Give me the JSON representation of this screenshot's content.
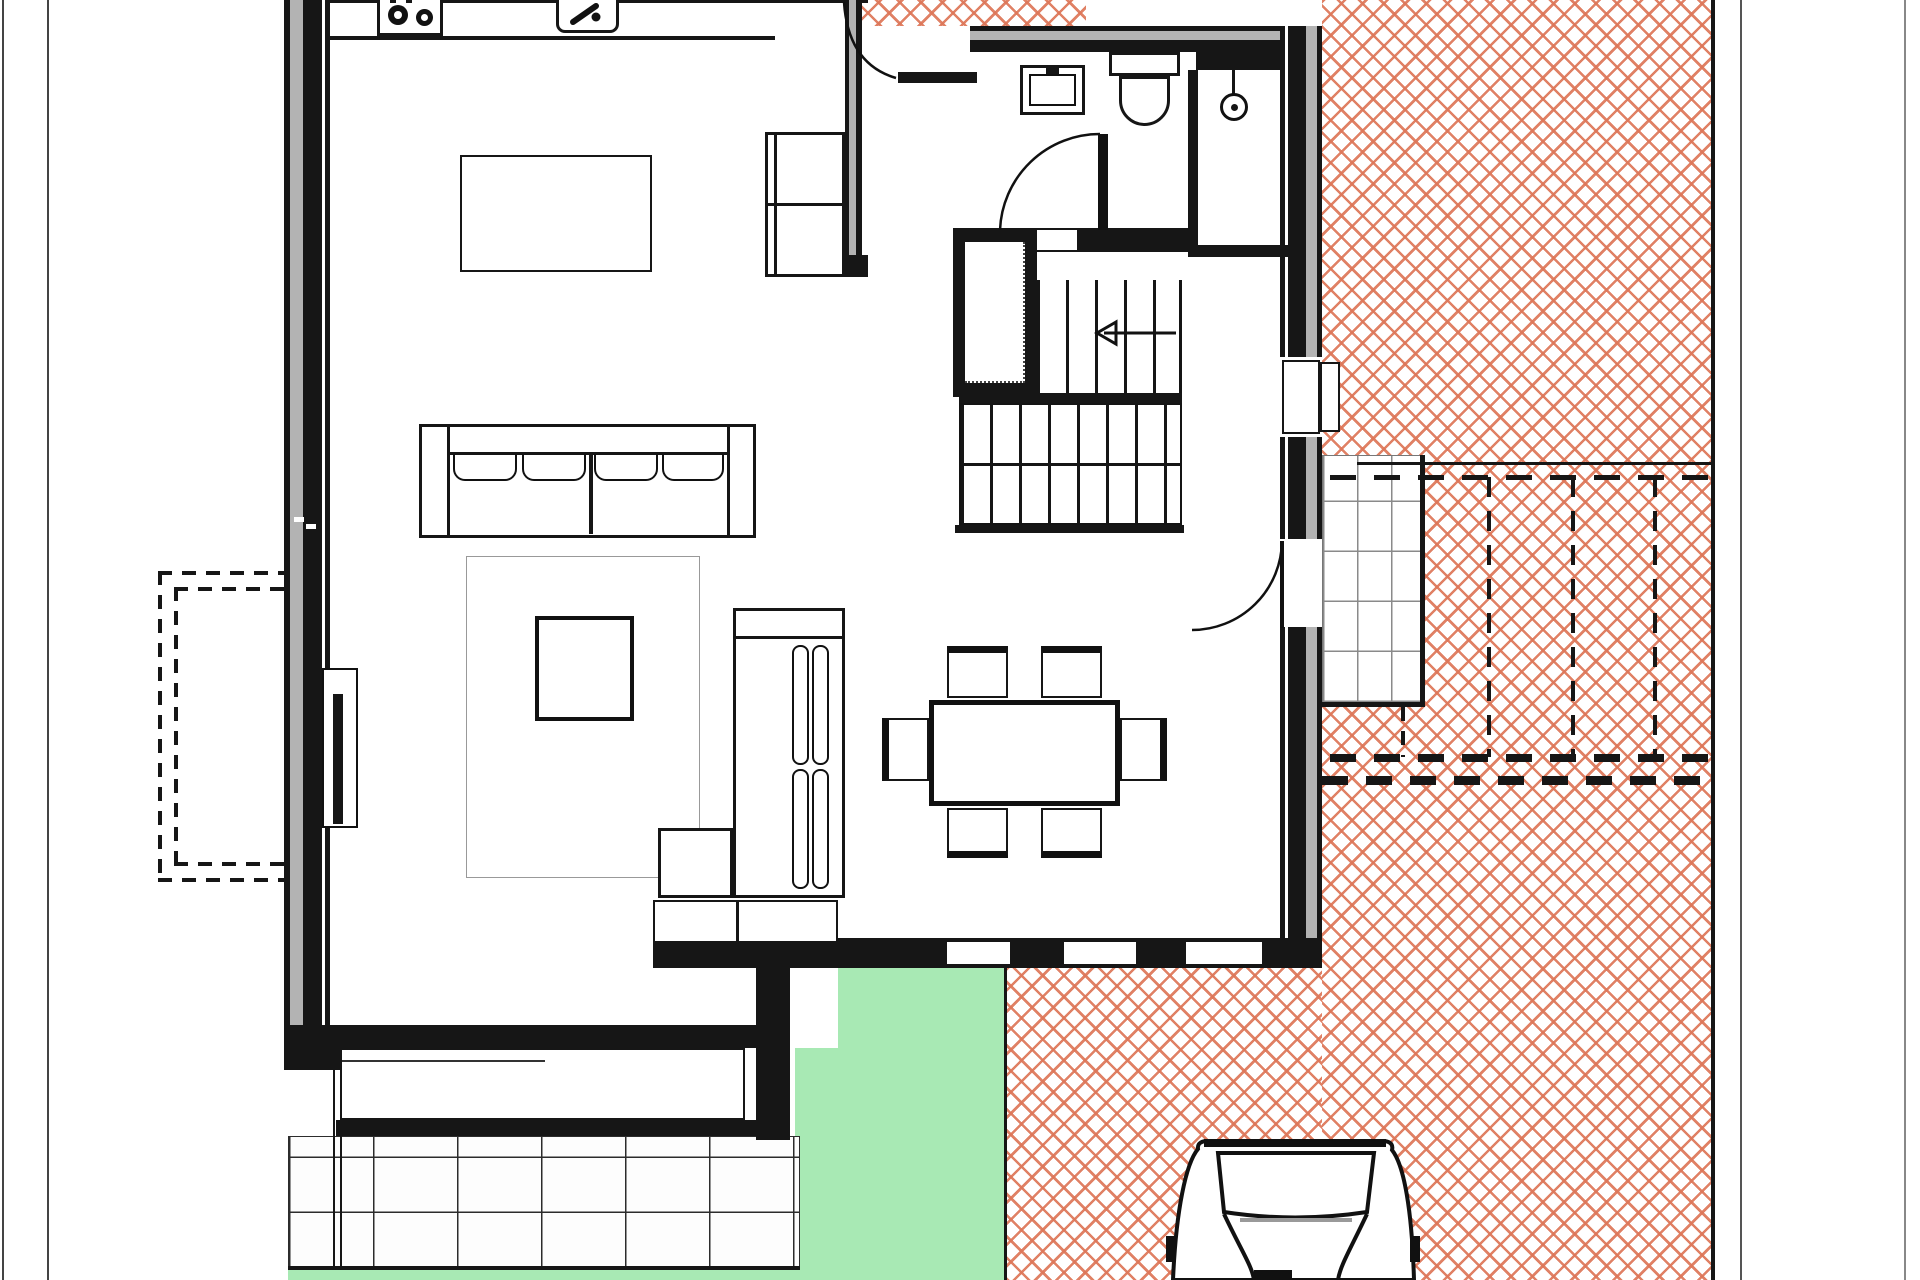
{
  "document": {
    "type": "architectural-floor-plan",
    "view": "top-down ground floor plan, partially cropped at top and bottom",
    "visible_text": []
  },
  "colors": {
    "background": "#ffffff",
    "ink": "#161616",
    "wall_core": "#b3b3b3",
    "paving_brick": "rgba(221,118,88,0.92)",
    "lawn_green": "#a8e9b4",
    "terrace_grid_line": "#2c2c2c",
    "landing_grid_line": "#8a8a8a",
    "rug_outline": "#999999",
    "frame_line": "#555555"
  },
  "rooms": {
    "kitchen_living": "open kitchen / living room (left)",
    "dining": "dining area (center right)",
    "hallway": "entrance hall (top center)",
    "bathroom": "bathroom with basin, wc and shower (top right)",
    "stairs": "switchback staircase with under-stair closet (center)"
  },
  "fixtures": [
    {
      "name": "stove",
      "burners": 2
    },
    {
      "name": "kitchen-sink",
      "faucet": true
    },
    {
      "name": "wash-basin"
    },
    {
      "name": "toilet"
    },
    {
      "name": "shower-head"
    },
    {
      "name": "radiator"
    }
  ],
  "furniture": [
    "kitchen island",
    "wall shelf unit",
    "sofa (4 cushions)",
    "rug",
    "coffee table",
    "chaise / daybed",
    "tv lowboard",
    "dining table",
    "6 dining chairs"
  ],
  "exterior": {
    "right_terrace": "herringbone brick paving",
    "exterior_steps": {
      "dashed_step_lines": 3
    },
    "stair_landing": "small tiled landing grid",
    "lower_left_terrace": "large tile grid",
    "lawn": "green lawn patch bottom center",
    "driveway": "herringbone paving with parked car",
    "dashed_overhang": "double dashed outline left of house",
    "car": {
      "count": 1,
      "location": "driveway bottom right"
    }
  },
  "counts": {
    "dining_chairs": 6,
    "stove_burners": 2,
    "sofa_cushions": 4
  }
}
